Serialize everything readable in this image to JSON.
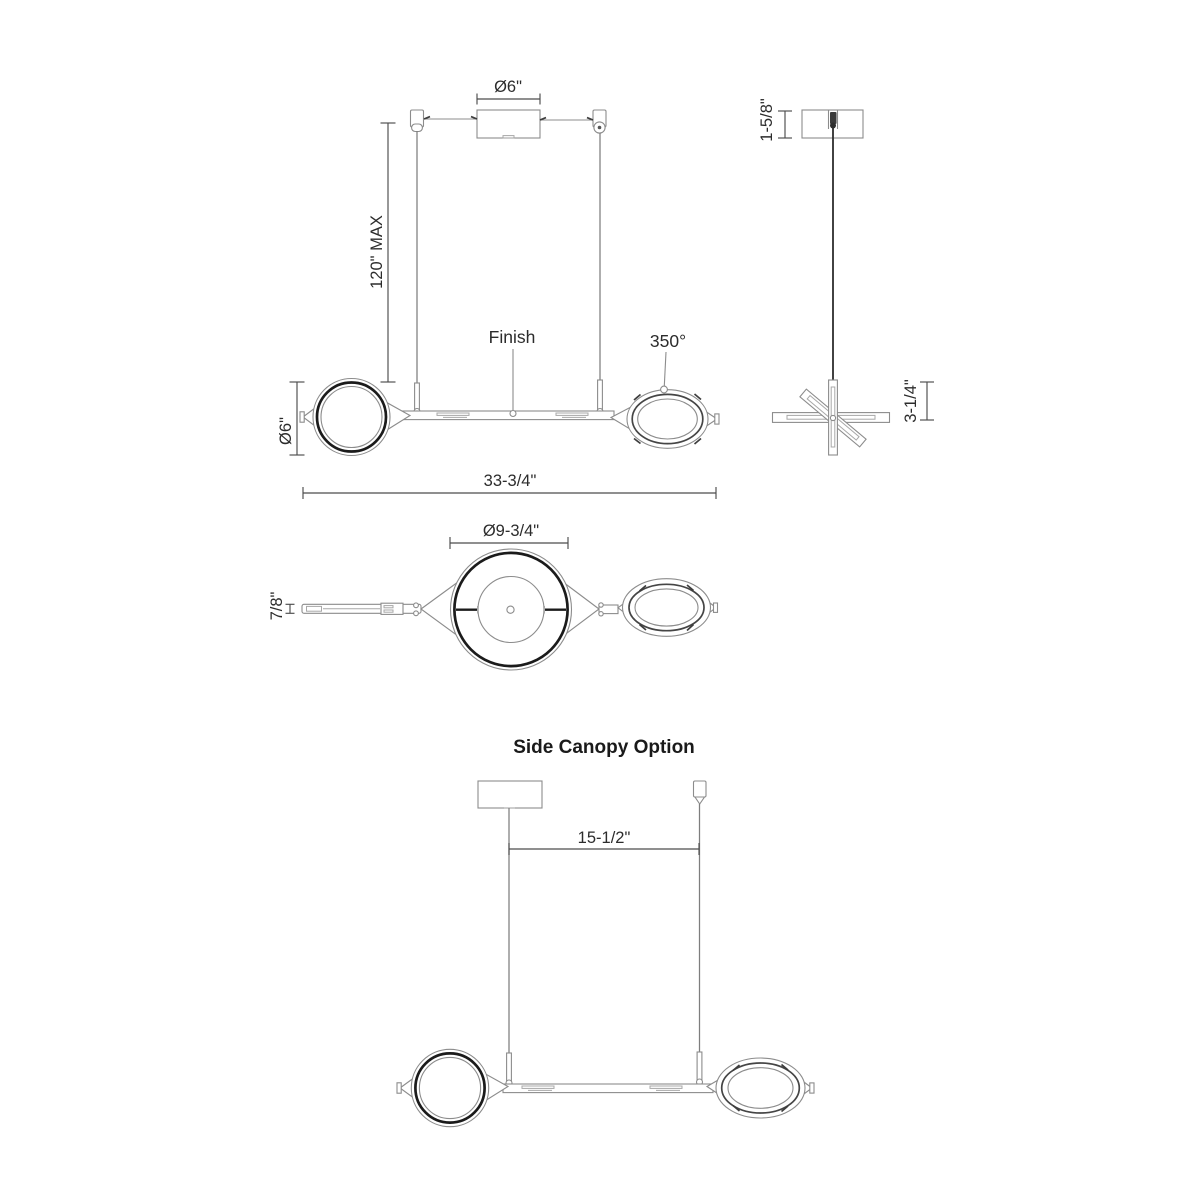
{
  "drawing_title": "Side Canopy Option",
  "front_view": {
    "canopy_diameter": "Ø6\"",
    "max_suspension": "120\" MAX",
    "finish_label": "Finish",
    "rotation_angle": "350°",
    "small_shade_diameter": "Ø6\"",
    "overall_width": "33-3/4\""
  },
  "side_view": {
    "canopy_height": "1-5/8\"",
    "fixture_height": "3-1/4\""
  },
  "plan_view": {
    "large_shade_diameter": "Ø9-3/4\"",
    "arm_width": "7/8\""
  },
  "side_canopy_view": {
    "title": "Side Canopy Option",
    "canopy_offset": "15-1/2\""
  },
  "colors": {
    "background": "#ffffff",
    "thin_line": "#8c8c8c",
    "bold_line": "#1b1b1b",
    "dimension_line": "#4c4c4c",
    "text": "#2c2c2c"
  }
}
